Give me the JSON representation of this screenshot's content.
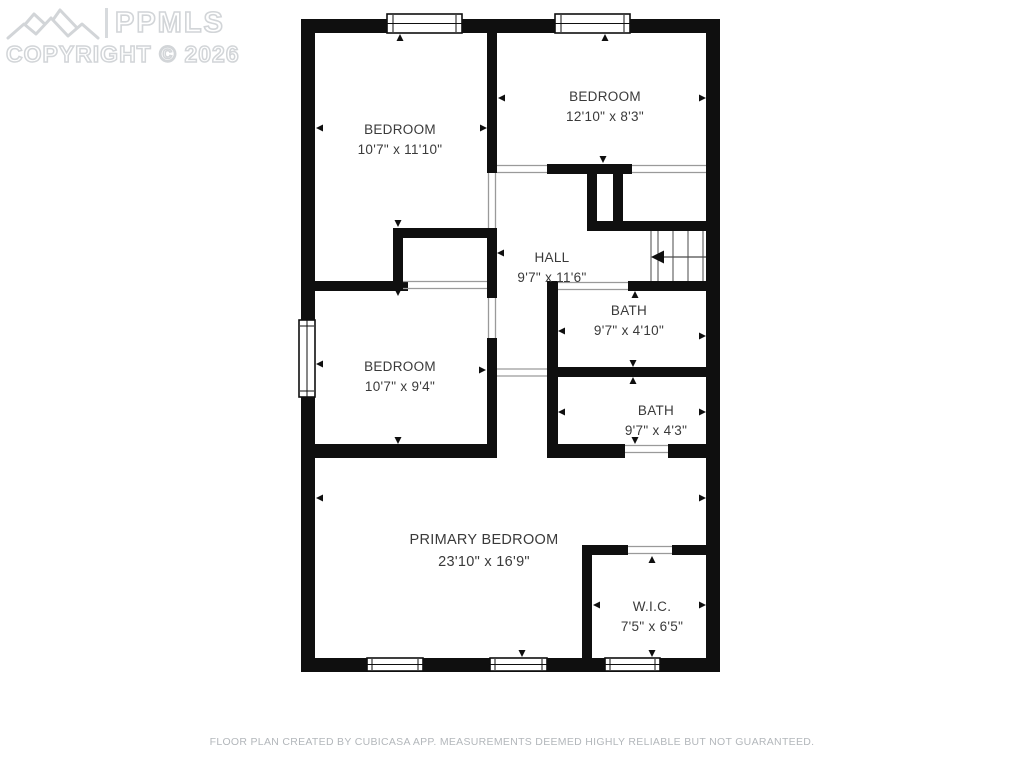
{
  "watermark": {
    "brand": "PPMLS",
    "copyright": "COPYRIGHT © 2026",
    "logo_icon": "ppmls-mountain-logo-icon"
  },
  "rooms": [
    {
      "id": "bedroom-top-left",
      "name": "BEDROOM",
      "dimensions": "10'7\" x 11'10\""
    },
    {
      "id": "bedroom-top-right",
      "name": "BEDROOM",
      "dimensions": "12'10\" x 8'3\""
    },
    {
      "id": "hall",
      "name": "HALL",
      "dimensions": "9'7\" x 11'6\""
    },
    {
      "id": "bath-upper",
      "name": "BATH",
      "dimensions": "9'7\" x 4'10\""
    },
    {
      "id": "bedroom-middle-left",
      "name": "BEDROOM",
      "dimensions": "10'7\" x 9'4\""
    },
    {
      "id": "bath-lower",
      "name": "BATH",
      "dimensions": "9'7\" x 4'3\""
    },
    {
      "id": "primary-bedroom",
      "name": "PRIMARY BEDROOM",
      "dimensions": "23'10\" x 16'9\""
    },
    {
      "id": "walk-in-closet",
      "name": "W.I.C.",
      "dimensions": "7'5\" x 6'5\""
    }
  ],
  "footer": {
    "disclaimer": "FLOOR PLAN CREATED BY CUBICASA APP. MEASUREMENTS DEEMED HIGHLY RELIABLE BUT NOT GUARANTEED."
  },
  "colors": {
    "wall": "#0f0f0f",
    "room_label": "#3a3a3a",
    "watermark": "#d2d5d8",
    "footer_text": "#b3b7bb",
    "background": "#ffffff"
  }
}
